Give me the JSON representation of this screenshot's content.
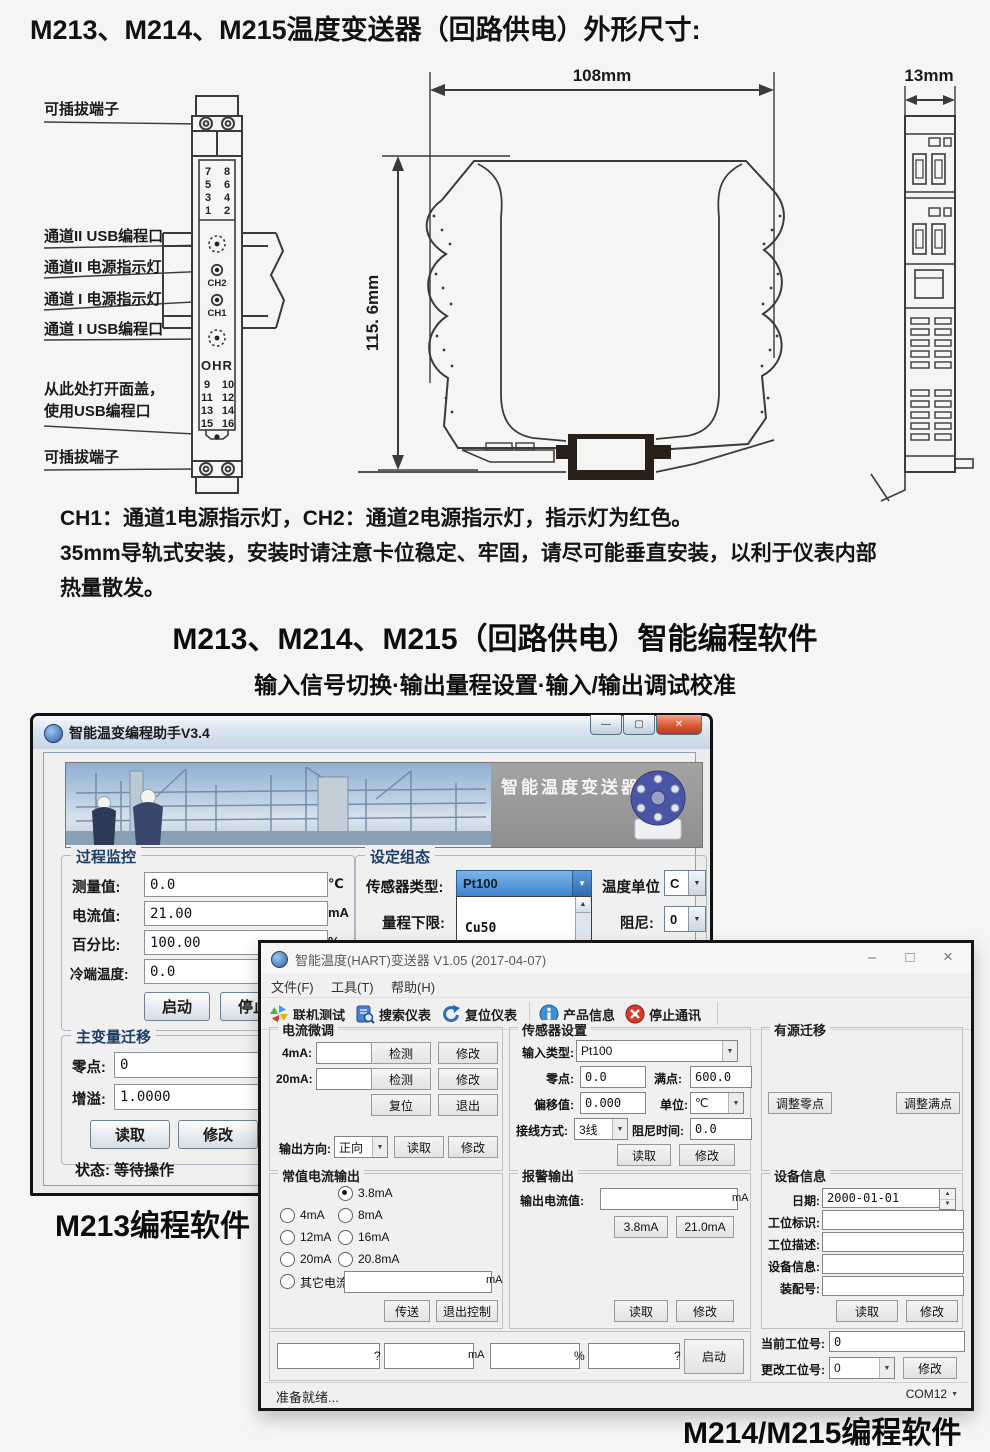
{
  "page": {
    "title": "M213、M214、M215温度变送器（回路供电）外形尺寸:",
    "note1": "CH1：通道1电源指示灯，CH2：通道2电源指示灯，指示灯为红色。",
    "note2": "35mm导轨式安装，安装时请注意卡位稳定、牢固，请尽可能垂直安装，以利于仪表内部",
    "note3": "热量散发。",
    "software_title": "M213、M214、M215（回路供电）智能编程软件",
    "software_subtitle": "输入信号切换·输出量程设置·输入/输出调试校准",
    "caption_m213": "M213编程软件",
    "caption_m214": "M214/M215编程软件"
  },
  "diagram": {
    "dim_width": "108mm",
    "dim_height": "115. 6mm",
    "dim_depth": "13mm",
    "label_plug_top": "可插拔端子",
    "label_ch2_usb": "通道II USB编程口",
    "label_ch2_led": "通道II 电源指示灯",
    "label_ch1_led": "通道 I 电源指示灯",
    "label_ch1_usb": "通道 I USB编程口",
    "label_open_cover_1": "从此处打开面盖，",
    "label_open_cover_2": "使用USB编程口",
    "label_plug_bottom": "可插拔端子",
    "module": {
      "ch1": "CH1",
      "ch2": "CH2",
      "logo": "OHR",
      "t": [
        "7",
        "8",
        "5",
        "6",
        "3",
        "4",
        "1",
        "2"
      ],
      "b": [
        "9",
        "10",
        "11",
        "12",
        "13",
        "14",
        "15",
        "16"
      ]
    }
  },
  "window1": {
    "title": "智能温变编程助手V3.4",
    "banner_caption": "智能温度变送器",
    "monitor": {
      "title": "过程监控",
      "measure_label": "测量值:",
      "measure_value": "0.0",
      "measure_unit": "℃",
      "current_label": "电流值:",
      "current_value": "21.00",
      "current_unit": "mA",
      "percent_label": "百分比:",
      "percent_value": "100.00",
      "percent_unit": "%",
      "cold_label": "冷端温度:",
      "cold_value": "0.0",
      "start_btn": "启动",
      "stop_btn": "停止"
    },
    "config": {
      "title": "设定组态",
      "sensor_label": "传感器类型:",
      "sensor_value": "Pt100",
      "unit_label": "温度单位",
      "unit_value": "C",
      "range_label": "量程下限:",
      "damping_label": "阻尼:",
      "damping_value": "0",
      "list_item_1": "Cu50",
      "list_item_2": "Pt100"
    },
    "shift": {
      "title": "主变量迁移",
      "zero_label": "零点:",
      "zero_value": "0",
      "gain_label": "增溢:",
      "gain_value": "1.0000",
      "read_btn": "读取",
      "modify_btn": "修改"
    },
    "status": "状态: 等待操作"
  },
  "window2": {
    "title": "智能温度(HART)变送器 V1.05 (2017-04-07)",
    "menu_file": "文件(F)",
    "menu_tool": "工具(T)",
    "menu_help": "帮助(H)",
    "tb1": "联机测试",
    "tb2": "搜索仪表",
    "tb3": "复位仪表",
    "tb4": "产品信息",
    "tb5": "停止通讯",
    "trim": {
      "title": "电流微调",
      "r4_label": "4mA:",
      "r20_label": "20mA:",
      "detect_btn": "检测",
      "modify_btn": "修改",
      "reset_btn": "复位",
      "exit_btn": "退出",
      "dir_label": "输出方向:",
      "dir_value": "正向",
      "read_btn": "读取"
    },
    "const_out": {
      "title": "常值电流输出",
      "opt1": "3.8mA",
      "opt2": "4mA",
      "opt3": "8mA",
      "opt4": "12mA",
      "opt5": "16mA",
      "opt6": "20mA",
      "opt7": "20.8mA",
      "other_label": "其它电流",
      "other_unit": "mA",
      "send_btn": "传送",
      "exit_btn": "退出控制"
    },
    "sensor": {
      "title": "传感器设置",
      "type_label": "输入类型:",
      "type_value": "Pt100",
      "zero_label": "零点:",
      "zero_value": "0.0",
      "full_label": "满点:",
      "full_value": "600.0",
      "offset_label": "偏移值:",
      "offset_value": "0.000",
      "unit_label": "单位:",
      "unit_value": "℃",
      "wire_label": "接线方式:",
      "wire_value": "3线",
      "damp_label": "阻尼时间:",
      "damp_value": "0.0",
      "read_btn": "读取",
      "modify_btn": "修改"
    },
    "alarm": {
      "title": "报警输出",
      "out_label": "输出电流值:",
      "out_unit": "mA",
      "low_btn": "3.8mA",
      "high_btn": "21.0mA",
      "read_btn": "读取",
      "modify_btn": "修改"
    },
    "active": {
      "title": "有源迁移",
      "zero_btn": "调整零点",
      "full_btn": "调整满点"
    },
    "device": {
      "title": "设备信息",
      "date_label": "日期:",
      "date_value": "2000-01-01",
      "tag_label": "工位标识:",
      "desc_label": "工位描述:",
      "info_label": "设备信息:",
      "asm_label": "装配号:",
      "read_btn": "读取",
      "modify_btn": "修改"
    },
    "bottom": {
      "sep1": "?",
      "sep2": "mA",
      "sep3": "%",
      "sep4": "?",
      "start_btn": "启动",
      "cur_label": "当前工位号:",
      "cur_value": "0",
      "chg_label": "更改工位号:",
      "chg_value": "0",
      "modify_btn": "修改"
    },
    "statusbar": {
      "text": "准备就绪...",
      "com": "COM12"
    }
  },
  "ui": {
    "arrow_down": "▼",
    "arrow_up": "▲",
    "min1": "—",
    "max1": "▢",
    "close1": "✕",
    "min2": "–",
    "max2": "□",
    "close2": "×"
  }
}
